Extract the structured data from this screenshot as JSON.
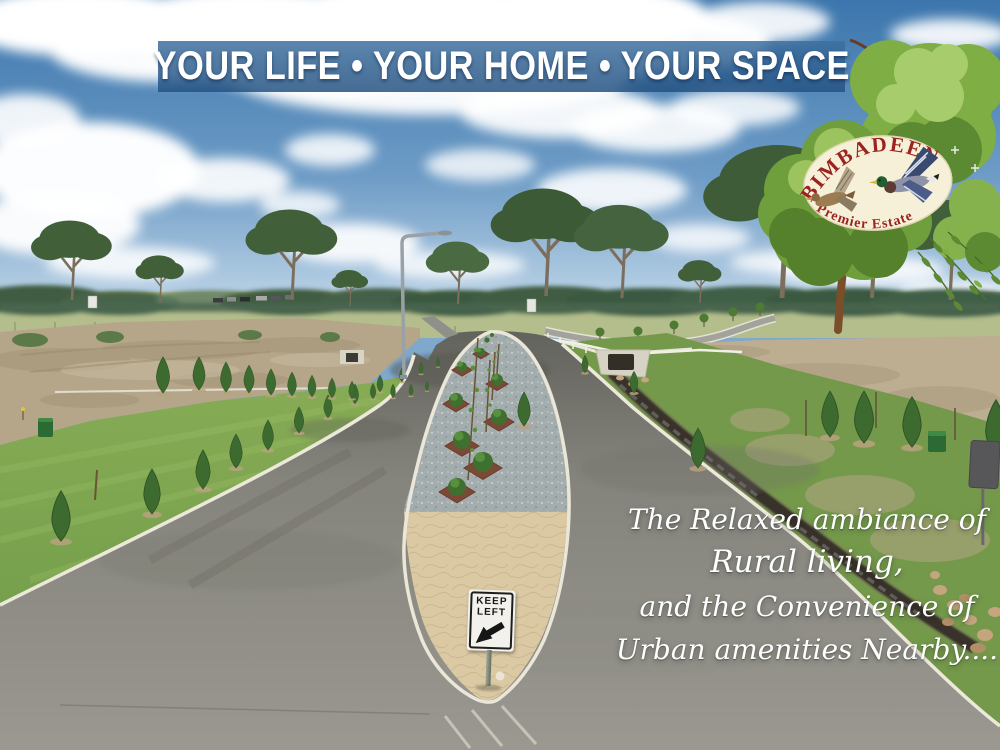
{
  "banner": {
    "text": "YOUR LIFE • YOUR HOME • YOUR SPACE"
  },
  "logo": {
    "name": "BIMBADEEN",
    "tagline": "Premier Estate"
  },
  "road_sign": {
    "line1": "KEEP",
    "line2": "LEFT"
  },
  "tagline": {
    "line1": "The Relaxed ambiance of",
    "line2": "Rural living,",
    "line3": "and the Convenience of",
    "line4": "Urban amenities Nearby...."
  },
  "colors": {
    "banner_blue": "#2f6398",
    "logo_red": "#9b2420",
    "badge_cream": "#f7f0d8",
    "kerb_white": "#ece8da",
    "sign_face": "#f2f1ec",
    "sky_top": "#3c76ad",
    "lawn_green": "#7fa855",
    "mulch_red": "#7c4937",
    "paver_tan": "#dbc9a4"
  }
}
